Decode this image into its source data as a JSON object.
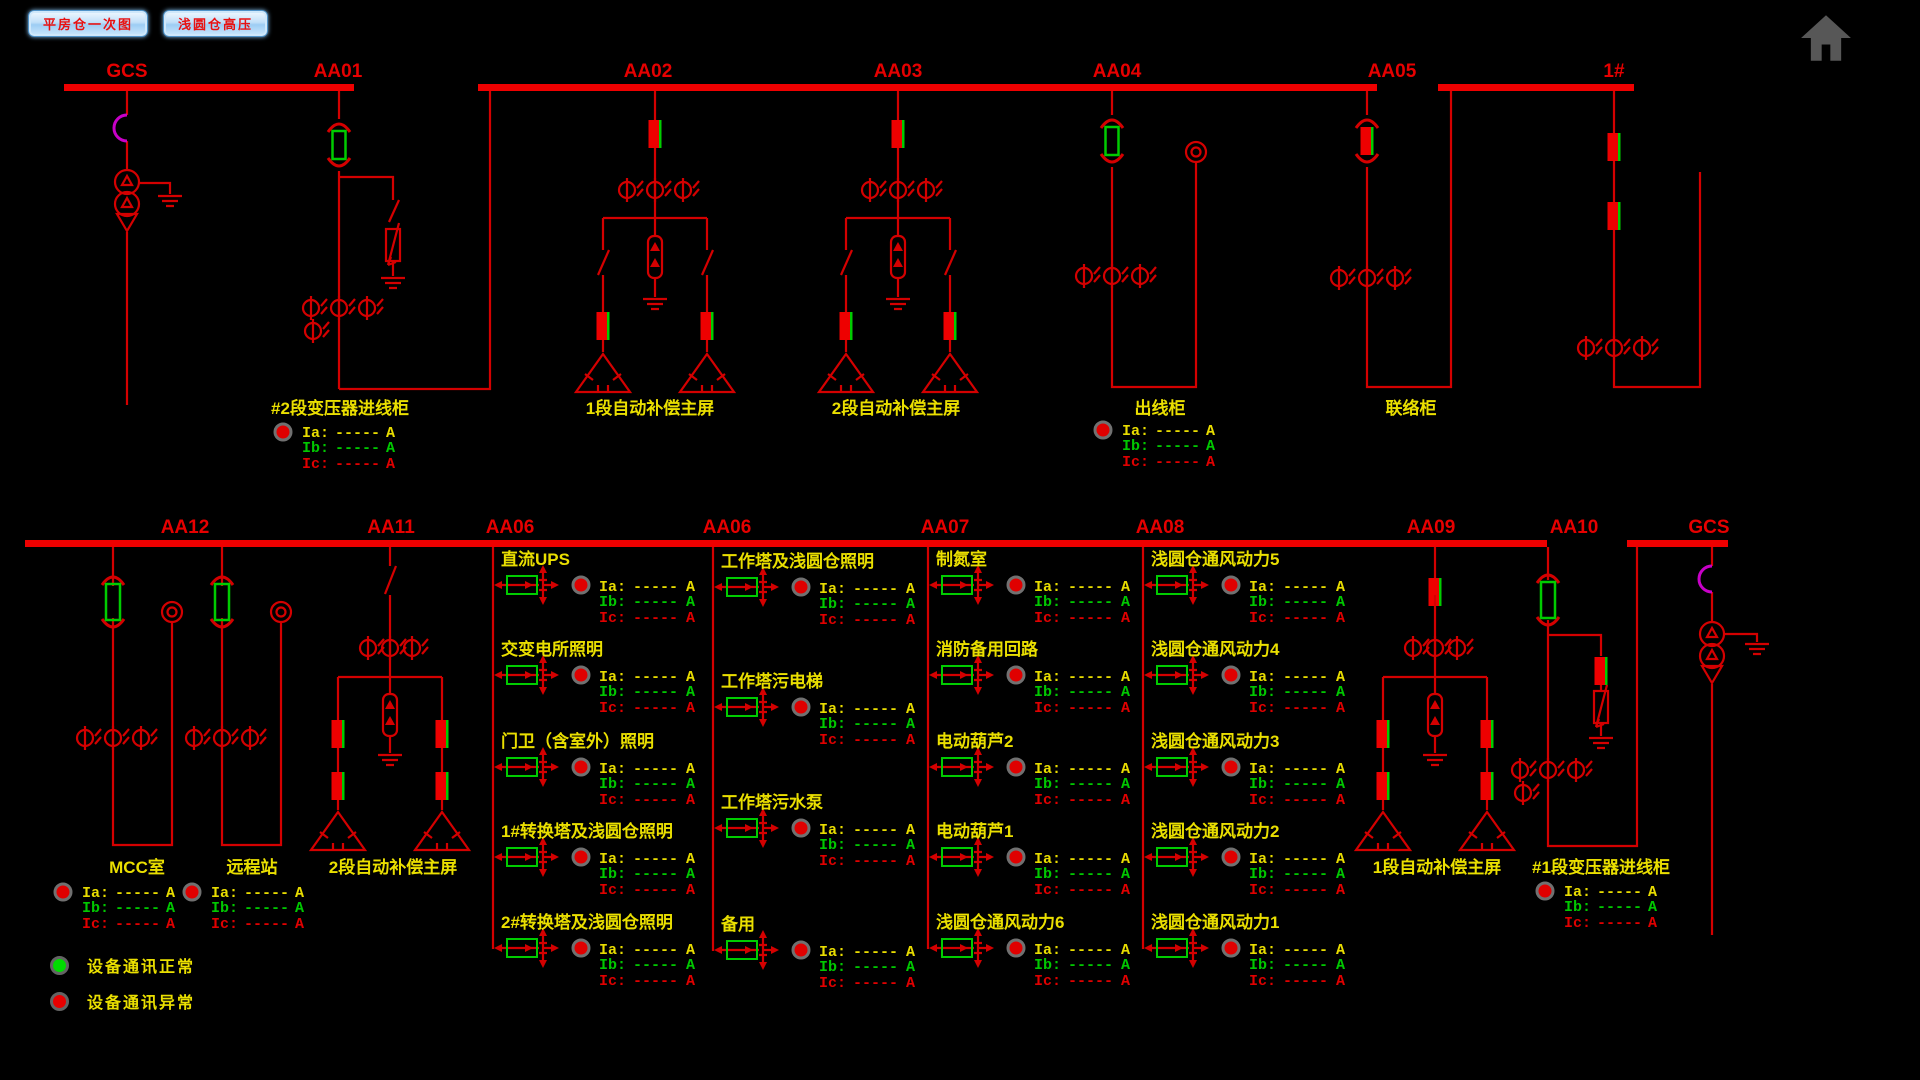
{
  "buttons": [
    {
      "label": "平房仓一次图"
    },
    {
      "label": "浅圆仓高压"
    }
  ],
  "top_section": {
    "bus_labels": [
      {
        "text": "GCS"
      },
      {
        "text": "AA01"
      },
      {
        "text": "AA02"
      },
      {
        "text": "AA03"
      },
      {
        "text": "AA04"
      },
      {
        "text": "AA05"
      },
      {
        "text": "1#"
      }
    ],
    "cabinets": [
      {
        "label": "#2段变压器进线柜",
        "has_readout": true
      },
      {
        "label": "1段自动补偿主屏",
        "has_readout": false
      },
      {
        "label": "2段自动补偿主屏",
        "has_readout": false
      },
      {
        "label": "出线柜",
        "has_readout": true
      },
      {
        "label": "联络柜",
        "has_readout": false
      }
    ]
  },
  "bottom_section": {
    "bus_labels": [
      {
        "text": "AA12"
      },
      {
        "text": "AA11"
      },
      {
        "text": "AA06"
      },
      {
        "text": "AA06"
      },
      {
        "text": "AA07"
      },
      {
        "text": "AA08"
      },
      {
        "text": "AA09"
      },
      {
        "text": "AA10"
      },
      {
        "text": "GCS"
      }
    ],
    "columns": [
      {
        "bus": "AA06",
        "feeders": [
          "直流UPS",
          "交变电所照明",
          "门卫（含室外）照明",
          "1#转换塔及浅圆仓照明",
          "2#转换塔及浅圆仓照明"
        ]
      },
      {
        "bus": "AA06",
        "feeders": [
          "工作塔及浅圆仓照明",
          "工作塔污电梯",
          "工作塔污水泵",
          "备用"
        ]
      },
      {
        "bus": "AA07",
        "feeders": [
          "制氮室",
          "消防备用回路",
          "电动葫芦2",
          "电动葫芦1",
          "浅圆仓通风动力6"
        ]
      },
      {
        "bus": "AA08",
        "feeders": [
          "浅圆仓通风动力5",
          "浅圆仓通风动力4",
          "浅圆仓通风动力3",
          "浅圆仓通风动力2",
          "浅圆仓通风动力1"
        ]
      }
    ],
    "cabinets": [
      {
        "label": "MCC室",
        "has_readout": true
      },
      {
        "label": "远程站",
        "has_readout": true
      },
      {
        "label": "2段自动补偿主屏",
        "has_readout": false
      },
      {
        "label": "1段自动补偿主屏",
        "has_readout": false
      },
      {
        "label": "#1段变压器进线柜",
        "has_readout": true
      }
    ]
  },
  "readout": {
    "rows": [
      {
        "label": "Ia:",
        "value": "-----",
        "unit": "A",
        "color": "#e8dc00"
      },
      {
        "label": "Ib:",
        "value": "-----",
        "unit": "A",
        "color": "#00c800"
      },
      {
        "label": "Ic:",
        "value": "-----",
        "unit": "A",
        "color": "#e00000"
      }
    ]
  },
  "legend": {
    "items": [
      {
        "label": "设备通讯正常",
        "status": "normal",
        "color": "#00dc00"
      },
      {
        "label": "设备通讯异常",
        "status": "abnormal",
        "color": "#e80000"
      }
    ]
  },
  "icons": {
    "home": "home-icon"
  },
  "colors": {
    "background": "#000000",
    "line_red": "#d40000",
    "bus_red": "#ee0000",
    "label_yellow": "#eadf00",
    "breaker_green": "#00cc00",
    "magenta": "#c800c8",
    "indicator_red": "#e00000",
    "indicator_ring": "#707070"
  }
}
